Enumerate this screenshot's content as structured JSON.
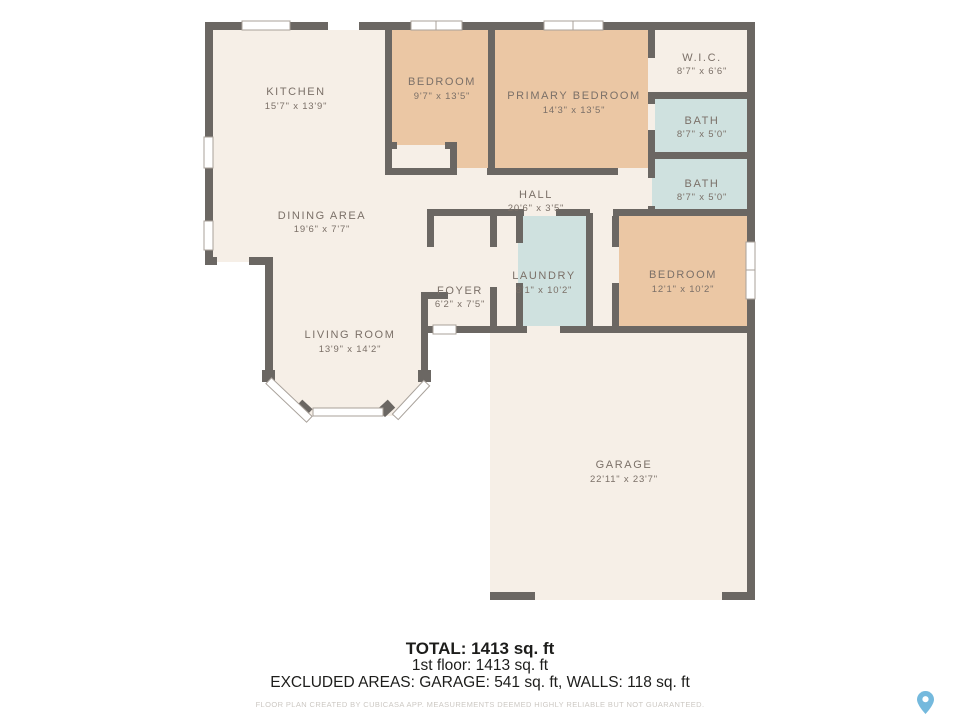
{
  "colors": {
    "wall": "#6b6763",
    "floor_cream": "#f6efe7",
    "room_peach": "#ebc7a4",
    "room_blue": "#cfe1df",
    "label": "#7b7068",
    "pin_blue": "#74b9dd"
  },
  "rooms": {
    "kitchen": {
      "name": "KITCHEN",
      "dims": "15'7\" x 13'9\""
    },
    "bedroom_top": {
      "name": "BEDROOM",
      "dims": "9'7\" x 13'5\""
    },
    "primary_bedroom": {
      "name": "PRIMARY BEDROOM",
      "dims": "14'3\" x 13'5\""
    },
    "wic": {
      "name": "W.I.C.",
      "dims": "8'7\" x 6'6\""
    },
    "bath_1": {
      "name": "BATH",
      "dims": "8'7\" x 5'0\""
    },
    "bath_2": {
      "name": "BATH",
      "dims": "8'7\" x 5'0\""
    },
    "hall": {
      "name": "HALL",
      "dims": "20'6\" x 3'5\""
    },
    "dining_area": {
      "name": "DINING AREA",
      "dims": "19'6\" x 7'7\""
    },
    "laundry": {
      "name": "LAUNDRY",
      "dims": "8'1\" x 10'2\""
    },
    "bedroom_right": {
      "name": "BEDROOM",
      "dims": "12'1\" x 10'2\""
    },
    "foyer": {
      "name": "FOYER",
      "dims": "6'2\" x 7'5\""
    },
    "living_room": {
      "name": "LIVING ROOM",
      "dims": "13'9\" x 14'2\""
    },
    "garage": {
      "name": "GARAGE",
      "dims": "22'11\" x 23'7\""
    }
  },
  "footer": {
    "total": "TOTAL: 1413 sq. ft",
    "first_floor": "1st floor: 1413 sq. ft",
    "excluded": "EXCLUDED AREAS: GARAGE: 541 sq. ft, WALLS: 118 sq. ft",
    "disclaimer": "FLOOR PLAN CREATED BY CUBICASA APP. MEASUREMENTS DEEMED HIGHLY RELIABLE BUT NOT GUARANTEED."
  },
  "icons": {
    "location_pin": "location-pin-icon"
  }
}
